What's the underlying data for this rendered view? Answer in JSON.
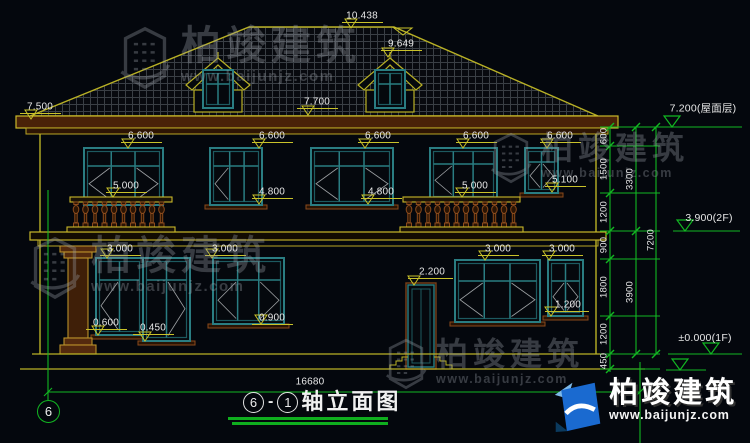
{
  "colors": {
    "background": "#04070d",
    "line_yellow": "#b9b125",
    "dim_yellow": "#c9c22a",
    "chain_green": "#12b722",
    "window_teal": "#2a7d82",
    "trim_brown": "#8a4a1c",
    "text": "#e7e7e7",
    "logo_blue": "#1a6ad0"
  },
  "title": {
    "bubble_left": "6",
    "bubble_right": "1",
    "label": "轴立面图"
  },
  "axis_bubble": "6",
  "bottom_dimension": {
    "t": "16680",
    "x": 310,
    "y": 382
  },
  "dim_labels": [
    {
      "t": "10.438",
      "x": 362,
      "y": 16,
      "ax": 351,
      "ay": 28
    },
    {
      "t": "9.649",
      "x": 401,
      "y": 44,
      "ax": 388,
      "ay": 57
    },
    {
      "t": "7.700",
      "x": 317,
      "y": 102,
      "ax": 308,
      "ay": 115
    },
    {
      "t": "7.500",
      "x": 40,
      "y": 107,
      "ax": 31,
      "ay": 119
    },
    {
      "t": "6.600",
      "x": 141,
      "y": 136,
      "ax": 128,
      "ay": 148
    },
    {
      "t": "6.600",
      "x": 272,
      "y": 136,
      "ax": 259,
      "ay": 148
    },
    {
      "t": "6.600",
      "x": 378,
      "y": 136,
      "ax": 365,
      "ay": 148
    },
    {
      "t": "6.600",
      "x": 476,
      "y": 136,
      "ax": 463,
      "ay": 148
    },
    {
      "t": "6.600",
      "x": 560,
      "y": 136,
      "ax": 547,
      "ay": 148
    },
    {
      "t": "5.000",
      "x": 126,
      "y": 186,
      "ax": 113,
      "ay": 197
    },
    {
      "t": "5.000",
      "x": 475,
      "y": 186,
      "ax": 462,
      "ay": 197
    },
    {
      "t": "5.100",
      "x": 565,
      "y": 180,
      "ax": 552,
      "ay": 192
    },
    {
      "t": "4.800",
      "x": 272,
      "y": 192,
      "ax": 259,
      "ay": 204
    },
    {
      "t": "4.800",
      "x": 381,
      "y": 192,
      "ax": 368,
      "ay": 204
    },
    {
      "t": "3.000",
      "x": 120,
      "y": 249,
      "ax": 107,
      "ay": 258
    },
    {
      "t": "3.000",
      "x": 225,
      "y": 249,
      "ax": 212,
      "ay": 258
    },
    {
      "t": "3.000",
      "x": 498,
      "y": 249,
      "ax": 485,
      "ay": 260
    },
    {
      "t": "3.000",
      "x": 562,
      "y": 249,
      "ax": 549,
      "ay": 260
    },
    {
      "t": "2.200",
      "x": 432,
      "y": 272,
      "ax": 414,
      "ay": 285
    },
    {
      "t": "1.200",
      "x": 568,
      "y": 305,
      "ax": 551,
      "ay": 316
    },
    {
      "t": "0.900",
      "x": 272,
      "y": 318,
      "ax": 261,
      "ay": 324
    },
    {
      "t": "0.600",
      "x": 106,
      "y": 323,
      "ax": 98,
      "ay": 335
    },
    {
      "t": "0.450",
      "x": 153,
      "y": 328,
      "ax": 145,
      "ay": 341
    }
  ],
  "chain_dimensions": {
    "inner": [
      {
        "t": "600",
        "y": 136
      },
      {
        "t": "1500",
        "y": 169
      },
      {
        "t": "1200",
        "y": 212
      },
      {
        "t": "900",
        "y": 245
      },
      {
        "t": "1800",
        "y": 287
      },
      {
        "t": "1200",
        "y": 334
      },
      {
        "t": "450",
        "y": 361
      }
    ],
    "middle": [
      {
        "t": "3300",
        "y": 179
      },
      {
        "t": "3900",
        "y": 292
      }
    ],
    "outer": [
      {
        "t": "7200",
        "y": 240
      }
    ]
  },
  "elevation_markers": [
    {
      "t": "7.200(屋面层)",
      "x": 703,
      "y": 108,
      "tx": 672,
      "ty": 127,
      "l1": 660,
      "l2": 742
    },
    {
      "t": "3.900(2F)",
      "x": 709,
      "y": 218,
      "tx": 685,
      "ty": 231,
      "l1": 673,
      "l2": 740
    },
    {
      "t": "±0.000(1F)",
      "x": 705,
      "y": 338,
      "tx": 711,
      "ty": 354,
      "l1": 668,
      "l2": 742
    },
    {
      "t": "",
      "x": 0,
      "y": 0,
      "tx": 680,
      "ty": 370,
      "l1": 666,
      "l2": 706
    }
  ],
  "watermark": {
    "brand": "柏竣建筑",
    "site": "www.baijunjz.com",
    "instances": [
      {
        "x": 116,
        "y": 26,
        "cls": "wm-a"
      },
      {
        "x": 488,
        "y": 132,
        "cls": "wm-b"
      },
      {
        "x": 26,
        "y": 236,
        "cls": "wm-a"
      },
      {
        "x": 383,
        "y": 338,
        "cls": "wm-b"
      }
    ]
  },
  "logo": {
    "brand": "柏竣建筑",
    "site": "www.baijunjz.com"
  }
}
